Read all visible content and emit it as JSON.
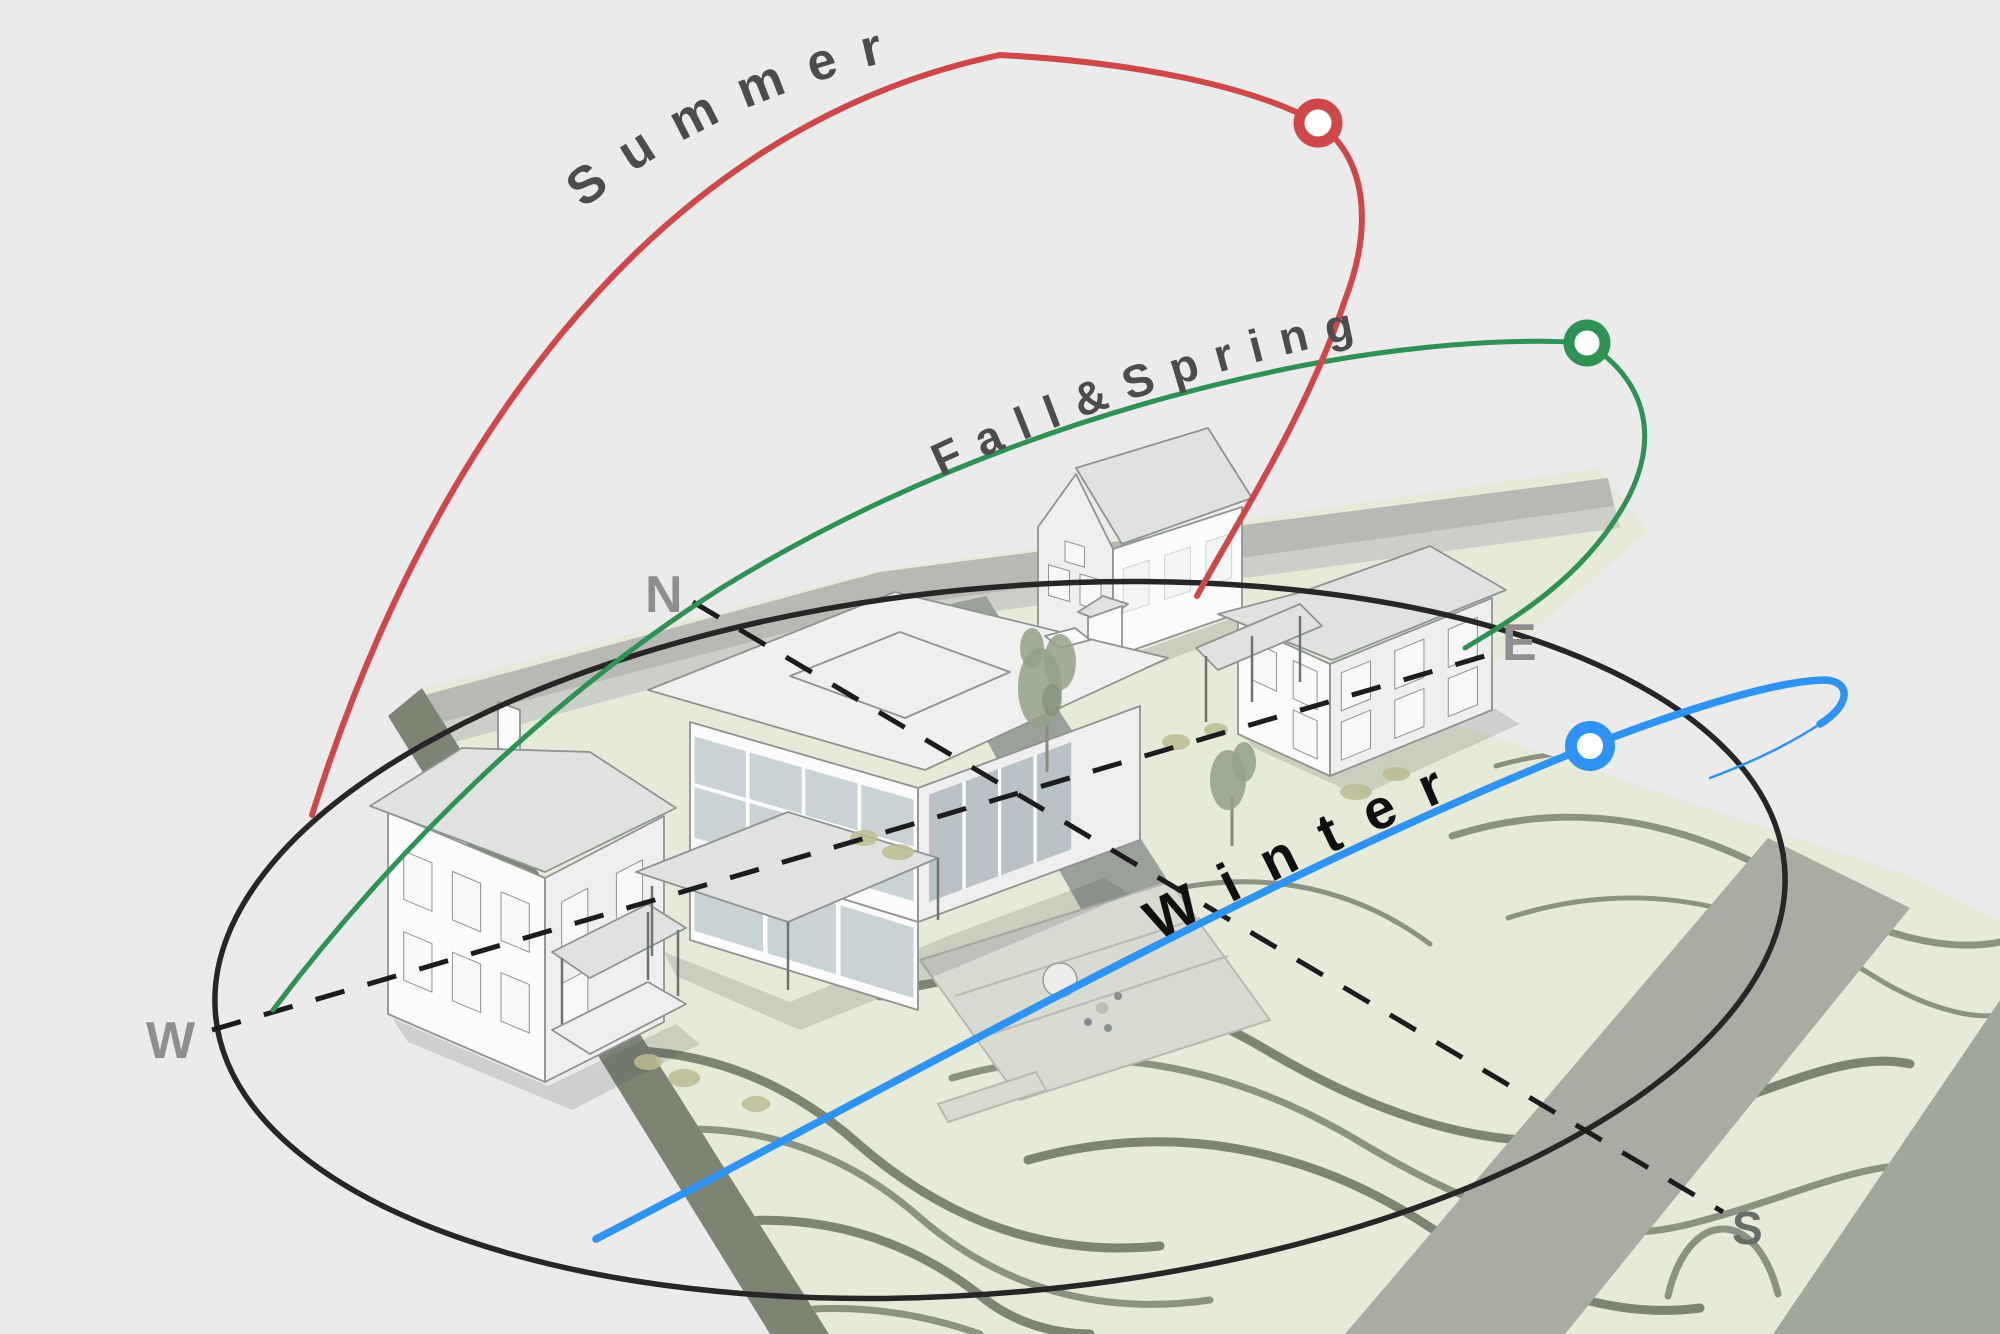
{
  "diagram": {
    "type": "seasonal-sun-path-site-diagram",
    "season_paths": [
      {
        "id": "summer",
        "label": "Summer",
        "color": "#cf4849"
      },
      {
        "id": "fall_spring",
        "label": "Fall&Spring",
        "color": "#2f9153"
      },
      {
        "id": "winter",
        "label": "Winter",
        "color": "#2e93f3"
      }
    ],
    "compass": {
      "north": "N",
      "east": "E",
      "south": "S",
      "west": "W"
    },
    "horizon_color": "#262626",
    "axis_color": "#1c1c1c"
  },
  "colors": {
    "bg": "#ebebec",
    "ground": "#e5ead9",
    "contour": "#8c9281",
    "contourDark": "#7e8473",
    "roadTop": "#b7bab3",
    "sidewalk": "#cccfc8",
    "roadRight": "#a8aca3",
    "driveway": "#9ba19a",
    "patio": "#d8dbd2",
    "patioLine": "#b7bab1",
    "slabSideL": "#7e8474",
    "slabSideR": "#a2a79c",
    "wall": "#fcfcfc",
    "wallShade": "#eeefee",
    "roof": "#f0f1ef",
    "roofShade": "#e0e2df",
    "outline": "#8f9492",
    "outlineDark": "#6f7472",
    "glass": "#c9d3d6",
    "glassDark": "#b9c3c7",
    "win": "#f7f8f7",
    "tree": "#93a188",
    "treeDark": "#7f8d74",
    "shrub": "#bcbc92",
    "shadow": "#3a3f38",
    "labelGray": "#8e8e8e",
    "labelS": "#686d66",
    "seasonText": "#4c4c4c",
    "winterText": "#101010",
    "axis": "#1c1c1c",
    "markerFill": "#ffffff"
  }
}
